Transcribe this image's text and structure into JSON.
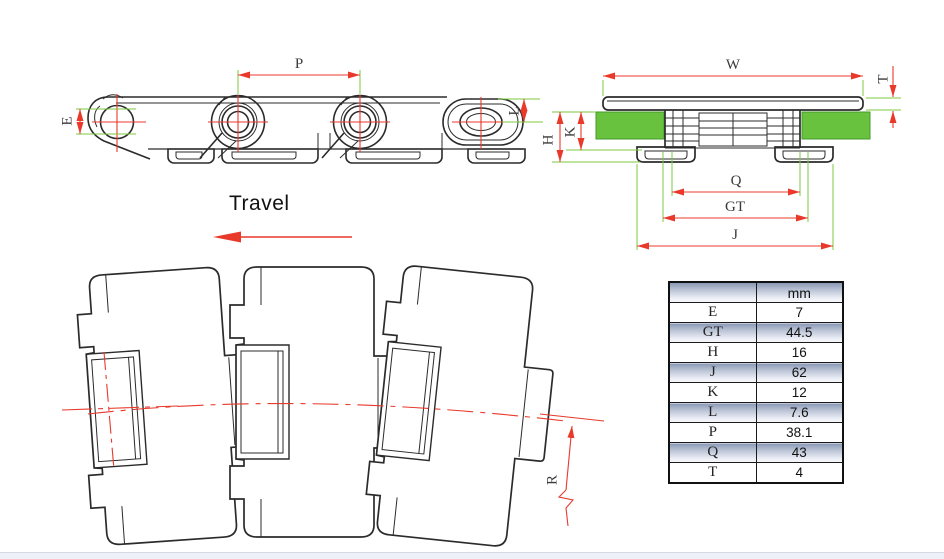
{
  "labels": {
    "travel": "Travel"
  },
  "dims": {
    "p": "P",
    "e": "E",
    "l": "L",
    "w": "W",
    "t": "T",
    "h": "H",
    "k": "K",
    "q": "Q",
    "gt": "GT",
    "j": "J",
    "r": "R"
  },
  "table": {
    "header": {
      "label": "",
      "unit": "mm"
    },
    "rows": [
      {
        "label": "E",
        "value": "7"
      },
      {
        "label": "GT",
        "value": "44.5"
      },
      {
        "label": "H",
        "value": "16"
      },
      {
        "label": "J",
        "value": "62"
      },
      {
        "label": "K",
        "value": "12"
      },
      {
        "label": "L",
        "value": "7.6"
      },
      {
        "label": "P",
        "value": "38.1"
      },
      {
        "label": "Q",
        "value": "43"
      },
      {
        "label": "T",
        "value": "4"
      }
    ]
  },
  "colors": {
    "dimension_red": "#e8392b",
    "guide_green": "#7cc83f",
    "wear_strip_green": "#69c23d",
    "line_black": "#2b2b2b",
    "table_shade_top": "#8a98b4"
  }
}
